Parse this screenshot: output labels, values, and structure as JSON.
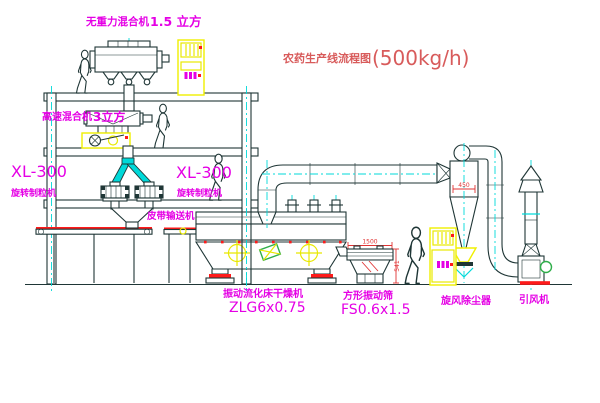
{
  "diagram": {
    "title": {
      "text": "农药生产线流程图",
      "capacity": "(500kg/h)"
    },
    "equipment_labels": {
      "gravity_free_mixer": {
        "name": "无重力混合机",
        "size": "1.5 立方"
      },
      "high_speed_mixer": {
        "name": "高速混合机",
        "size": "3立方"
      },
      "granulator_left": {
        "model": "XL-300",
        "name": "旋转制粒机"
      },
      "granulator_center": {
        "model": "XL-300",
        "name": "旋转制粒机"
      },
      "belt_conveyor": "皮带输送机",
      "fluid_bed_dryer": {
        "name": "振动流化床干燥机",
        "model": "ZLG6x0.75"
      },
      "vibrating_sieve": {
        "name": "方形振动筛",
        "model": "FS0.6x1.5"
      },
      "cyclone": "旋风除尘器",
      "induced_draft_fan": "引风机"
    },
    "dimensions": {
      "sieve_length": "1500",
      "sieve_height": "541",
      "cyclone_inlet": "450"
    },
    "colors": {
      "line": "#1f3636",
      "centerline_cyan": "#00d9d9",
      "label_magenta": "#e500e5",
      "title_red": "#d85b5b",
      "highlight_yellow": "#f0f000",
      "accent_red": "#ff1a1a",
      "accent_green": "#2fae4a"
    }
  }
}
